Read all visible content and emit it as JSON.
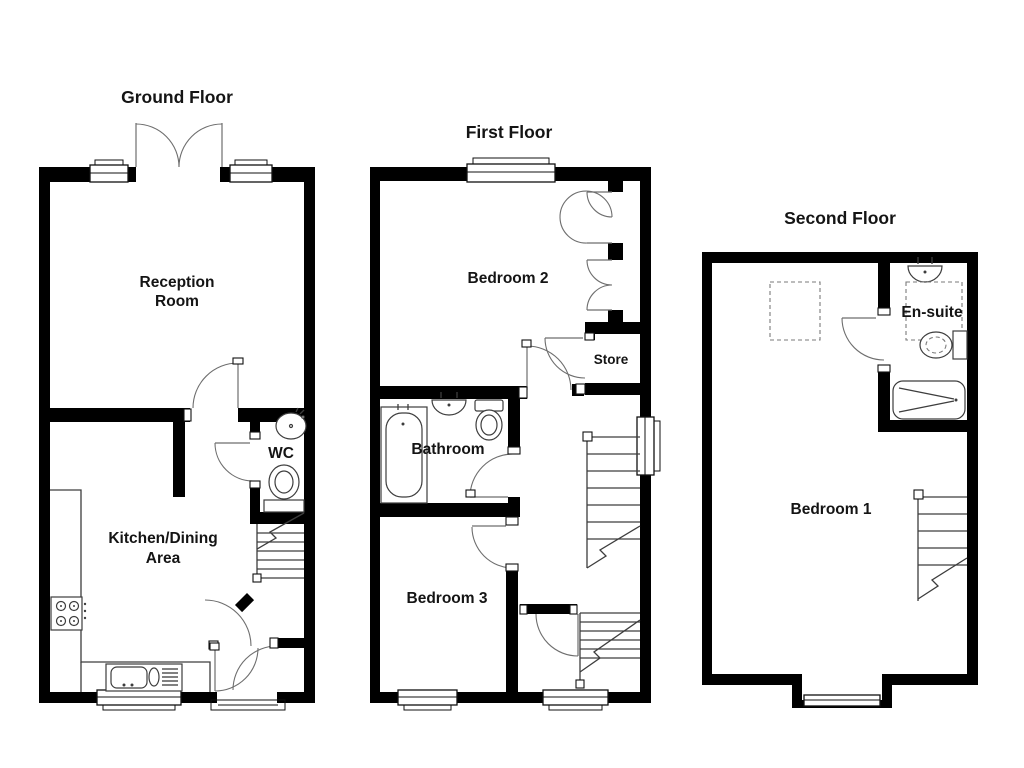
{
  "figure": {
    "background": "#ffffff",
    "wall_color": "#000000",
    "line_color": "#3d3d3d"
  },
  "floors": [
    {
      "id": "ground-floor",
      "title": "Ground Floor",
      "rooms": [
        {
          "name": "reception-room",
          "label_line1": "Reception",
          "label_line2": "Room"
        },
        {
          "name": "kitchen-dining-area",
          "label_line1": "Kitchen/Dining",
          "label_line2": "Area"
        },
        {
          "name": "wc",
          "label_line1": "WC"
        }
      ]
    },
    {
      "id": "first-floor",
      "title": "First Floor",
      "rooms": [
        {
          "name": "bedroom-2",
          "label_line1": "Bedroom 2"
        },
        {
          "name": "store",
          "label_line1": "Store"
        },
        {
          "name": "bathroom",
          "label_line1": "Bathroom"
        },
        {
          "name": "bedroom-3",
          "label_line1": "Bedroom 3"
        }
      ]
    },
    {
      "id": "second-floor",
      "title": "Second Floor",
      "rooms": [
        {
          "name": "en-suite",
          "label_line1": "En-suite"
        },
        {
          "name": "bedroom-1",
          "label_line1": "Bedroom 1"
        }
      ]
    }
  ]
}
